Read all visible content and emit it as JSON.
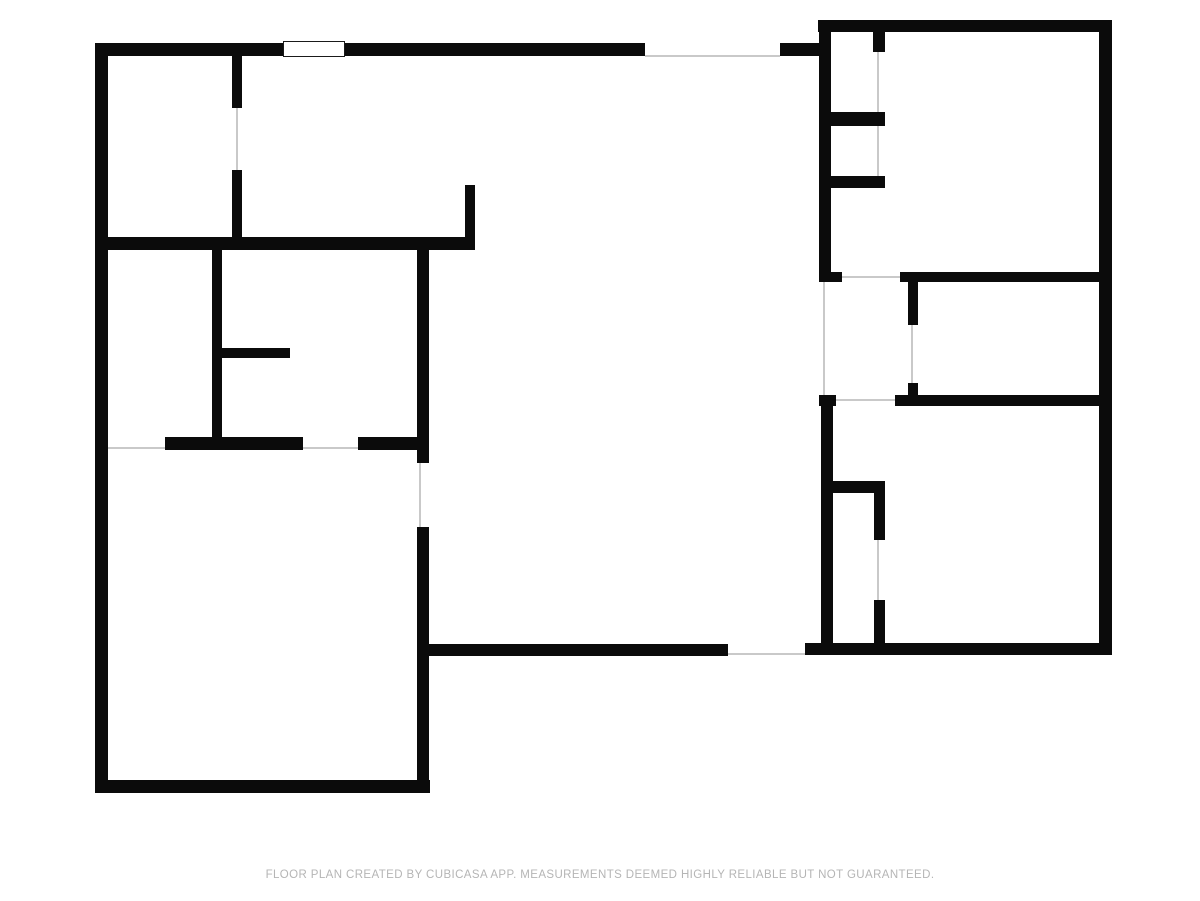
{
  "page": {
    "width": 1200,
    "height": 901,
    "background": "#ffffff"
  },
  "colors": {
    "wall": "#0b0b0b",
    "label_text": "#3d3d3d",
    "opening_line": "#c9c9c9",
    "footer_text": "#b5b5b5"
  },
  "footer": {
    "text": "FLOOR PLAN CREATED BY CUBICASA APP. MEASUREMENTS DEEMED HIGHLY RELIABLE BUT NOT GUARANTEED."
  },
  "rooms": [
    {
      "id": "laundry",
      "name": "LAUNDRY",
      "dimensions": "5'9\" x 8'1\"",
      "cx": 170,
      "cy": 150
    },
    {
      "id": "kitchen",
      "name": "KITCHEN",
      "dimensions": "10'5\" x 8'1\"",
      "cx": 355,
      "cy": 147
    },
    {
      "id": "dining-area",
      "name": "DINING AREA",
      "dimensions": "15'6\" x 8'5\"",
      "cx": 648,
      "cy": 148
    },
    {
      "id": "bedroom-top-right",
      "name": "BEDROOM",
      "dimensions": "12'1\" x 10'9\"",
      "cx": 982,
      "cy": 162
    },
    {
      "id": "wic",
      "name": "W.I.C.",
      "dimensions": "4'9\" x 8'7\"",
      "cx": 160,
      "cy": 346
    },
    {
      "id": "bath-left",
      "name": "BATH",
      "dimensions": "8'10\" x 8'7\"",
      "cx": 332,
      "cy": 339
    },
    {
      "id": "hall",
      "name": "HALL",
      "dimensions": "4'0\" x 5'2\"",
      "cx": 866,
      "cy": 332
    },
    {
      "id": "bath-right",
      "name": "BATH",
      "dimensions": "8'2\" x 5'2\"",
      "cx": 988,
      "cy": 338
    },
    {
      "id": "living-room",
      "name": "LIVING ROOM",
      "dimensions": "17'8\" x 17'9\"",
      "cx": 623,
      "cy": 448
    },
    {
      "id": "bedroom-bottom-right",
      "name": "BEDROOM",
      "dimensions": "12'1\" x 10'8\"",
      "cx": 982,
      "cy": 520
    },
    {
      "id": "primary-bedroom",
      "name": "PRIMARY BEDROOM",
      "dimensions": "14'0\" x 15'0\"",
      "cx": 262,
      "cy": 618
    }
  ],
  "walls": [
    {
      "name": "wall-exterior-top-main",
      "x": 95,
      "y": 43,
      "w": 550,
      "h": 13
    },
    {
      "name": "wall-exterior-top-connector",
      "x": 780,
      "y": 43,
      "w": 51,
      "h": 13
    },
    {
      "name": "wall-bedroom1-top",
      "x": 818,
      "y": 20,
      "w": 294,
      "h": 12
    },
    {
      "name": "wall-exterior-right",
      "x": 1099,
      "y": 20,
      "w": 13,
      "h": 635
    },
    {
      "name": "wall-exterior-left",
      "x": 95,
      "y": 43,
      "w": 13,
      "h": 750
    },
    {
      "name": "wall-primary-bottom",
      "x": 95,
      "y": 780,
      "w": 335,
      "h": 13
    },
    {
      "name": "wall-living-bottom",
      "x": 417,
      "y": 644,
      "w": 311,
      "h": 12
    },
    {
      "name": "wall-bedroom2-bottom",
      "x": 805,
      "y": 643,
      "w": 307,
      "h": 12
    },
    {
      "name": "wall-laundry-kitchen-divider-upper",
      "x": 232,
      "y": 55,
      "w": 10,
      "h": 53
    },
    {
      "name": "wall-laundry-kitchen-divider-lower",
      "x": 232,
      "y": 170,
      "w": 10,
      "h": 68
    },
    {
      "name": "wall-mid-horizontal",
      "x": 95,
      "y": 237,
      "w": 380,
      "h": 13
    },
    {
      "name": "wall-kitchen-peninsula",
      "x": 465,
      "y": 185,
      "w": 10,
      "h": 52
    },
    {
      "name": "wall-wic-bath-divider",
      "x": 212,
      "y": 250,
      "w": 10,
      "h": 187
    },
    {
      "name": "wall-bath1-stub",
      "x": 222,
      "y": 348,
      "w": 68,
      "h": 10
    },
    {
      "name": "wall-wic-bath-bottom-left",
      "x": 165,
      "y": 437,
      "w": 138,
      "h": 13
    },
    {
      "name": "wall-wic-bath-bottom-right",
      "x": 358,
      "y": 437,
      "w": 71,
      "h": 13
    },
    {
      "name": "wall-living-left-upper",
      "x": 417,
      "y": 245,
      "w": 12,
      "h": 218
    },
    {
      "name": "wall-living-left-lower",
      "x": 417,
      "y": 527,
      "w": 12,
      "h": 266
    },
    {
      "name": "wall-bedroom1-left",
      "x": 819,
      "y": 32,
      "w": 12,
      "h": 250
    },
    {
      "name": "wall-closet1-stub",
      "x": 873,
      "y": 32,
      "w": 12,
      "h": 20
    },
    {
      "name": "wall-closet1-bottom",
      "x": 828,
      "y": 112,
      "w": 57,
      "h": 14
    },
    {
      "name": "wall-closet2-bottom",
      "x": 828,
      "y": 176,
      "w": 57,
      "h": 12
    },
    {
      "name": "wall-hall-top-stub",
      "x": 819,
      "y": 272,
      "w": 23,
      "h": 10
    },
    {
      "name": "wall-bath2-top",
      "x": 900,
      "y": 272,
      "w": 199,
      "h": 10
    },
    {
      "name": "wall-hall-bath2-divider-upper",
      "x": 908,
      "y": 282,
      "w": 10,
      "h": 43
    },
    {
      "name": "wall-hall-bath2-divider-lower",
      "x": 908,
      "y": 383,
      "w": 10,
      "h": 23
    },
    {
      "name": "wall-hall-bottom-stub",
      "x": 819,
      "y": 395,
      "w": 17,
      "h": 11
    },
    {
      "name": "wall-bath2-bottom",
      "x": 895,
      "y": 395,
      "w": 204,
      "h": 11
    },
    {
      "name": "wall-bedroom2-left",
      "x": 821,
      "y": 395,
      "w": 12,
      "h": 252
    },
    {
      "name": "wall-closet3-top",
      "x": 828,
      "y": 481,
      "w": 57,
      "h": 12
    },
    {
      "name": "wall-closet3-right-upper",
      "x": 874,
      "y": 493,
      "w": 11,
      "h": 47
    },
    {
      "name": "wall-closet3-right-lower",
      "x": 874,
      "y": 600,
      "w": 11,
      "h": 45
    }
  ],
  "windows": [
    {
      "name": "window-kitchen-top",
      "x": 283,
      "y": 41,
      "w": 62,
      "h": 16
    },
    {
      "name": "window-bedroom1-top",
      "x": 935,
      "y": 18,
      "w": 70,
      "h": 16
    },
    {
      "name": "window-living-bottom-left",
      "x": 488,
      "y": 642,
      "w": 70,
      "h": 16
    },
    {
      "name": "window-living-bottom-right",
      "x": 574,
      "y": 642,
      "w": 68,
      "h": 16
    },
    {
      "name": "window-bedroom2-bottom",
      "x": 951,
      "y": 641,
      "w": 72,
      "h": 16
    },
    {
      "name": "window-primary-bottom",
      "x": 222,
      "y": 778,
      "w": 72,
      "h": 17
    }
  ],
  "openings": [
    {
      "name": "opening-dining-top-exterior",
      "x": 645,
      "y": 55,
      "w": 135,
      "h": 1.5
    },
    {
      "name": "opening-living-bottom-exterior",
      "x": 728,
      "y": 653,
      "w": 77,
      "h": 1.5
    },
    {
      "name": "door-laundry-kitchen",
      "x": 236,
      "y": 108,
      "w": 1.5,
      "h": 62
    },
    {
      "name": "door-wic",
      "x": 108,
      "y": 447,
      "w": 57,
      "h": 1.5
    },
    {
      "name": "door-bath1",
      "x": 303,
      "y": 447,
      "w": 55,
      "h": 1.5
    },
    {
      "name": "door-living-primary",
      "x": 419,
      "y": 463,
      "w": 1.5,
      "h": 64
    },
    {
      "name": "opening-hall-living",
      "x": 823,
      "y": 282,
      "w": 1.5,
      "h": 113
    },
    {
      "name": "door-bedroom1-hall",
      "x": 842,
      "y": 276,
      "w": 58,
      "h": 1.5
    },
    {
      "name": "door-bedroom2-hall",
      "x": 836,
      "y": 399,
      "w": 59,
      "h": 1.5
    },
    {
      "name": "door-bath2-hall",
      "x": 911,
      "y": 325,
      "w": 1.5,
      "h": 58
    },
    {
      "name": "opening-closet1",
      "x": 877,
      "y": 52,
      "w": 1.5,
      "h": 60
    },
    {
      "name": "opening-closet2",
      "x": 877,
      "y": 126,
      "w": 1.5,
      "h": 50
    },
    {
      "name": "opening-closet3",
      "x": 877,
      "y": 540,
      "w": 1.5,
      "h": 60
    }
  ],
  "arrows": [
    {
      "name": "arrow-laundry-top",
      "dir": "up",
      "x": 168,
      "y": 60
    },
    {
      "name": "arrow-laundry-bottom",
      "dir": "down",
      "x": 168,
      "y": 231
    },
    {
      "name": "arrow-laundry-left",
      "dir": "left",
      "x": 104,
      "y": 147
    },
    {
      "name": "arrow-laundry-right",
      "dir": "right",
      "x": 228,
      "y": 147
    },
    {
      "name": "arrow-kitchen-top",
      "dir": "up",
      "x": 354,
      "y": 60
    },
    {
      "name": "arrow-kitchen-bottom",
      "dir": "down",
      "x": 354,
      "y": 231
    },
    {
      "name": "arrow-kitchen-left",
      "dir": "left",
      "x": 247,
      "y": 123
    },
    {
      "name": "arrow-kitchen-right",
      "dir": "right",
      "x": 461,
      "y": 123
    },
    {
      "name": "arrow-dining-top",
      "dir": "up",
      "x": 647,
      "y": 61
    },
    {
      "name": "arrow-dining-bottom",
      "dir": "down",
      "x": 647,
      "y": 240
    },
    {
      "name": "arrow-dining-left",
      "dir": "left",
      "x": 479,
      "y": 151
    },
    {
      "name": "arrow-dining-right",
      "dir": "right",
      "x": 814,
      "y": 152
    },
    {
      "name": "arrow-bedroom1-top",
      "dir": "up",
      "x": 990,
      "y": 37
    },
    {
      "name": "arrow-bedroom1-bottom",
      "dir": "down",
      "x": 990,
      "y": 267
    },
    {
      "name": "arrow-bedroom1-left",
      "dir": "left",
      "x": 836,
      "y": 228
    },
    {
      "name": "arrow-bedroom1-right",
      "dir": "right",
      "x": 1094,
      "y": 228
    },
    {
      "name": "arrow-wic-top",
      "dir": "up",
      "x": 159,
      "y": 255
    },
    {
      "name": "arrow-wic-bottom",
      "dir": "down",
      "x": 159,
      "y": 432
    },
    {
      "name": "arrow-wic-left",
      "dir": "left",
      "x": 112,
      "y": 342
    },
    {
      "name": "arrow-wic-right",
      "dir": "right",
      "x": 207,
      "y": 342
    },
    {
      "name": "arrow-bath1-top",
      "dir": "up",
      "x": 353,
      "y": 255
    },
    {
      "name": "arrow-bath1-bottom",
      "dir": "down",
      "x": 353,
      "y": 432
    },
    {
      "name": "arrow-bath1-left",
      "dir": "left",
      "x": 228,
      "y": 338
    },
    {
      "name": "arrow-bath1-right",
      "dir": "right",
      "x": 412,
      "y": 338
    },
    {
      "name": "arrow-hall-top",
      "dir": "up",
      "x": 866,
      "y": 287
    },
    {
      "name": "arrow-hall-bottom",
      "dir": "down",
      "x": 866,
      "y": 390
    },
    {
      "name": "arrow-hall-left",
      "dir": "left",
      "x": 828,
      "y": 338
    },
    {
      "name": "arrow-hall-right",
      "dir": "right",
      "x": 903,
      "y": 338
    },
    {
      "name": "arrow-bath2-top",
      "dir": "up",
      "x": 1008,
      "y": 287
    },
    {
      "name": "arrow-bath2-bottom",
      "dir": "down",
      "x": 1008,
      "y": 390
    },
    {
      "name": "arrow-bath2-left",
      "dir": "left",
      "x": 924,
      "y": 338
    },
    {
      "name": "arrow-bath2-right",
      "dir": "right",
      "x": 1094,
      "y": 338
    },
    {
      "name": "arrow-living-top",
      "dir": "up",
      "x": 620,
      "y": 247
    },
    {
      "name": "arrow-living-bottom",
      "dir": "down",
      "x": 623,
      "y": 637
    },
    {
      "name": "arrow-living-left",
      "dir": "left",
      "x": 434,
      "y": 443
    },
    {
      "name": "arrow-living-right",
      "dir": "right",
      "x": 812,
      "y": 444
    },
    {
      "name": "arrow-bedroom2-top",
      "dir": "up",
      "x": 990,
      "y": 410
    },
    {
      "name": "arrow-bedroom2-bottom",
      "dir": "down",
      "x": 990,
      "y": 637
    },
    {
      "name": "arrow-bedroom2-left",
      "dir": "left",
      "x": 837,
      "y": 447
    },
    {
      "name": "arrow-bedroom2-right",
      "dir": "right",
      "x": 1094,
      "y": 445
    },
    {
      "name": "arrow-primary-top",
      "dir": "up",
      "x": 262,
      "y": 451
    },
    {
      "name": "arrow-primary-bottom",
      "dir": "down",
      "x": 262,
      "y": 775
    },
    {
      "name": "arrow-primary-left",
      "dir": "left",
      "x": 112,
      "y": 613
    },
    {
      "name": "arrow-primary-right",
      "dir": "right",
      "x": 412,
      "y": 613
    }
  ]
}
